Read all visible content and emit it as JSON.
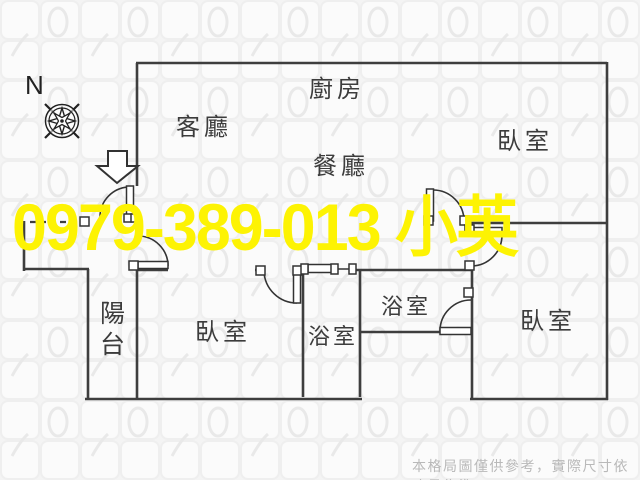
{
  "watermark": {
    "text": "0979-389-013 小英",
    "color": "#fdf303"
  },
  "compass": {
    "label": "N"
  },
  "rooms": {
    "living": {
      "label": "客廳"
    },
    "kitchen": {
      "label": "廚房"
    },
    "dining": {
      "label": "餐廳"
    },
    "bedroom_top_right": {
      "label": "臥室"
    },
    "bedroom_left": {
      "label": "臥室"
    },
    "bedroom_bottom_right": {
      "label": "臥室"
    },
    "balcony": {
      "label": "陽\n台"
    },
    "bathroom_left": {
      "label": "浴室"
    },
    "bathroom_middle": {
      "label": "浴室"
    }
  },
  "footer": {
    "disclaimer": "本格局圖僅供參考，實際尺寸依丈量為準"
  },
  "colors": {
    "wall": "#3e3e3e",
    "door": "#333333",
    "label": "#3c3c3c",
    "watermark": "#fdf303",
    "disclaimer": "#b9b9b9"
  }
}
